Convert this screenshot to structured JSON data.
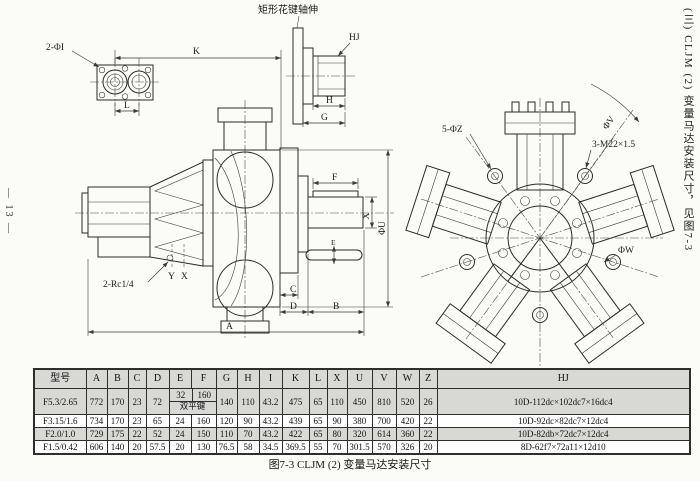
{
  "page": {
    "page_number": "— 13 —",
    "margin_note": "(三) CLJM (2) 变量马达安装尺寸，见图7-3",
    "caption": "图7-3 CLJM (2) 变量马达安装尺寸"
  },
  "drawing": {
    "spline_note": "矩形花键轴伸",
    "labels": {
      "ports": "2-ΦI",
      "k": "K",
      "l": "L",
      "hj": "HJ",
      "h": "H",
      "g": "G",
      "f": "F",
      "e": "E",
      "x_dim": "X",
      "phi_u": "ΦU",
      "c": "C",
      "d": "D",
      "b": "B",
      "a": "A",
      "rc_ports": "2-Rc1/4",
      "y_port": "Y",
      "x_port": "X",
      "bolt_holes": "5-ΦZ",
      "thread_holes": "3-M22×1.5",
      "phi_v": "ΦV",
      "phi_w": "ΦW"
    }
  },
  "table": {
    "headers": [
      "型号",
      "A",
      "B",
      "C",
      "D",
      "E",
      "F",
      "G",
      "H",
      "I",
      "K",
      "L",
      "X",
      "U",
      "V",
      "W",
      "Z",
      "HJ"
    ],
    "rows": [
      {
        "model": "F5.3/2.65",
        "a": "772",
        "b": "170",
        "c": "23",
        "d": "72",
        "e_top": "32",
        "f_top": "160",
        "ef_note": "双平键",
        "g": "140",
        "h": "110",
        "i": "43.2",
        "k": "475",
        "l": "65",
        "x": "110",
        "u": "450",
        "v": "810",
        "w": "520",
        "z": "26",
        "hj": "10D-112dc×102dc7×16dc4"
      },
      {
        "model": "F3.15/1.6",
        "a": "734",
        "b": "170",
        "c": "23",
        "d": "65",
        "e": "24",
        "f": "160",
        "g": "120",
        "h": "90",
        "i": "43.2",
        "k": "439",
        "l": "65",
        "x": "90",
        "u": "380",
        "v": "700",
        "w": "420",
        "z": "22",
        "hj": "10D-92dc×82dc7×12dc4"
      },
      {
        "model": "F2.0/1.0",
        "a": "729",
        "b": "175",
        "c": "22",
        "d": "52",
        "e": "24",
        "f": "150",
        "g": "110",
        "h": "70",
        "i": "43.2",
        "k": "422",
        "l": "65",
        "x": "80",
        "u": "320",
        "v": "614",
        "w": "360",
        "z": "22",
        "hj": "10D-82db×72dc7×12dc4"
      },
      {
        "model": "F1.5/0.42",
        "a": "606",
        "b": "140",
        "c": "20",
        "d": "57.5",
        "e": "20",
        "f": "130",
        "g": "76.5",
        "h": "58",
        "i": "34.5",
        "k": "369.5",
        "l": "55",
        "x": "70",
        "u": "301.5",
        "v": "570",
        "w": "326",
        "z": "20",
        "hj": "8D-62f7×72a11×12d10"
      }
    ]
  }
}
